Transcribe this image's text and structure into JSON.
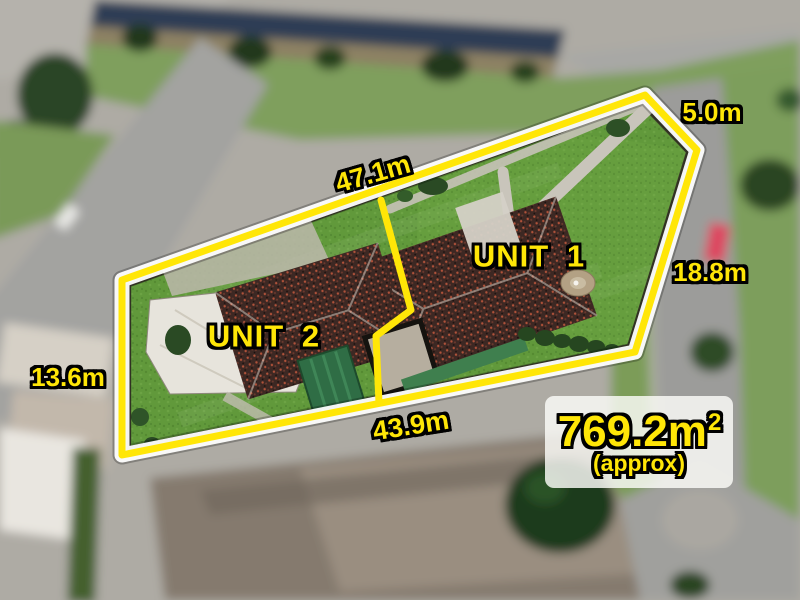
{
  "scene": {
    "description": "Aerial drone photo of a duplex property with yellow land-boundary overlay"
  },
  "boundary": {
    "measurements": [
      {
        "side": "top",
        "label": "47.1m"
      },
      {
        "side": "top-right",
        "label": "5.0m"
      },
      {
        "side": "right",
        "label": "18.8m"
      },
      {
        "side": "left",
        "label": "13.6m"
      },
      {
        "side": "bottom",
        "label": "43.9m"
      }
    ]
  },
  "units": [
    {
      "label": "UNIT 1"
    },
    {
      "label": "UNIT 2"
    }
  ],
  "area_badge": {
    "value": "769.2m",
    "exponent": "2",
    "qualifier": "(approx)"
  },
  "colors": {
    "boundary_yellow": "#ffe607",
    "boundary_glow": "#ffffff",
    "label_yellow": "#ffe607",
    "label_outline": "#000000",
    "badge_background": "rgba(252,252,249,0.82)"
  }
}
